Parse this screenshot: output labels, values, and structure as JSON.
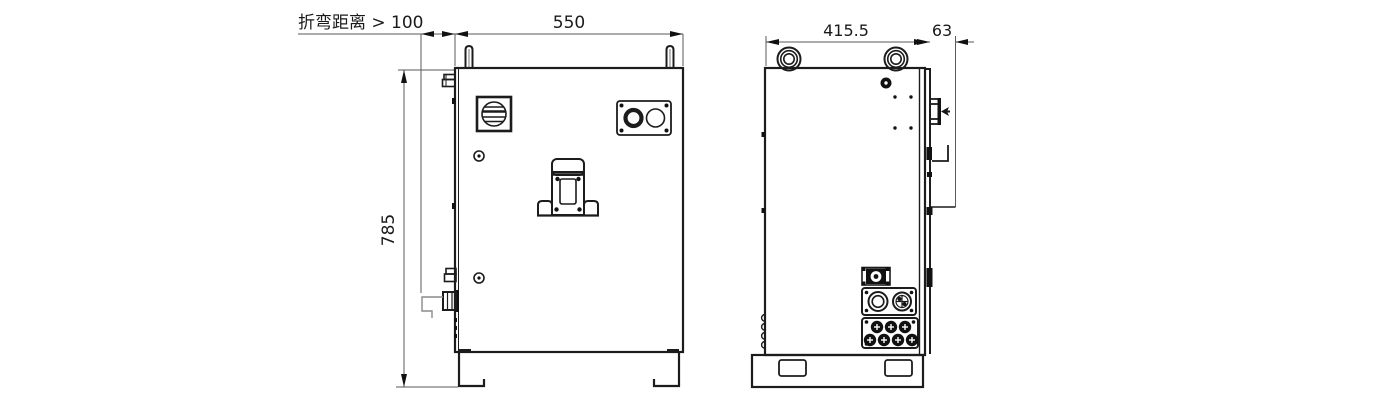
{
  "drawing": {
    "kind": "cabinet-dimension-drawing",
    "views": [
      {
        "name": "front-view",
        "annotations": [
          "bend_distance",
          "width",
          "height"
        ]
      },
      {
        "name": "side-view",
        "annotations": [
          "depth",
          "handle_depth"
        ]
      }
    ]
  },
  "labels": {
    "bend_distance": "折弯距离 > 100",
    "width": "550",
    "height": "785",
    "depth": "415.5",
    "handle_depth": "63"
  },
  "components": {
    "front": [
      "lifting-post",
      "rotary-main-switch",
      "indicator-button-plate",
      "door-lock-handle",
      "cable-gland",
      "bent-cable",
      "mounting-feet"
    ],
    "side": [
      "lifting-eye",
      "vent-hole",
      "door-handle-profile",
      "fan-plate",
      "round-connector-plate",
      "multi-pin-connector-plate",
      "base-bracket"
    ]
  },
  "colors": {
    "outline": "#1c1c1c",
    "dim_line": "#5a5a5a",
    "background": "#ffffff"
  }
}
